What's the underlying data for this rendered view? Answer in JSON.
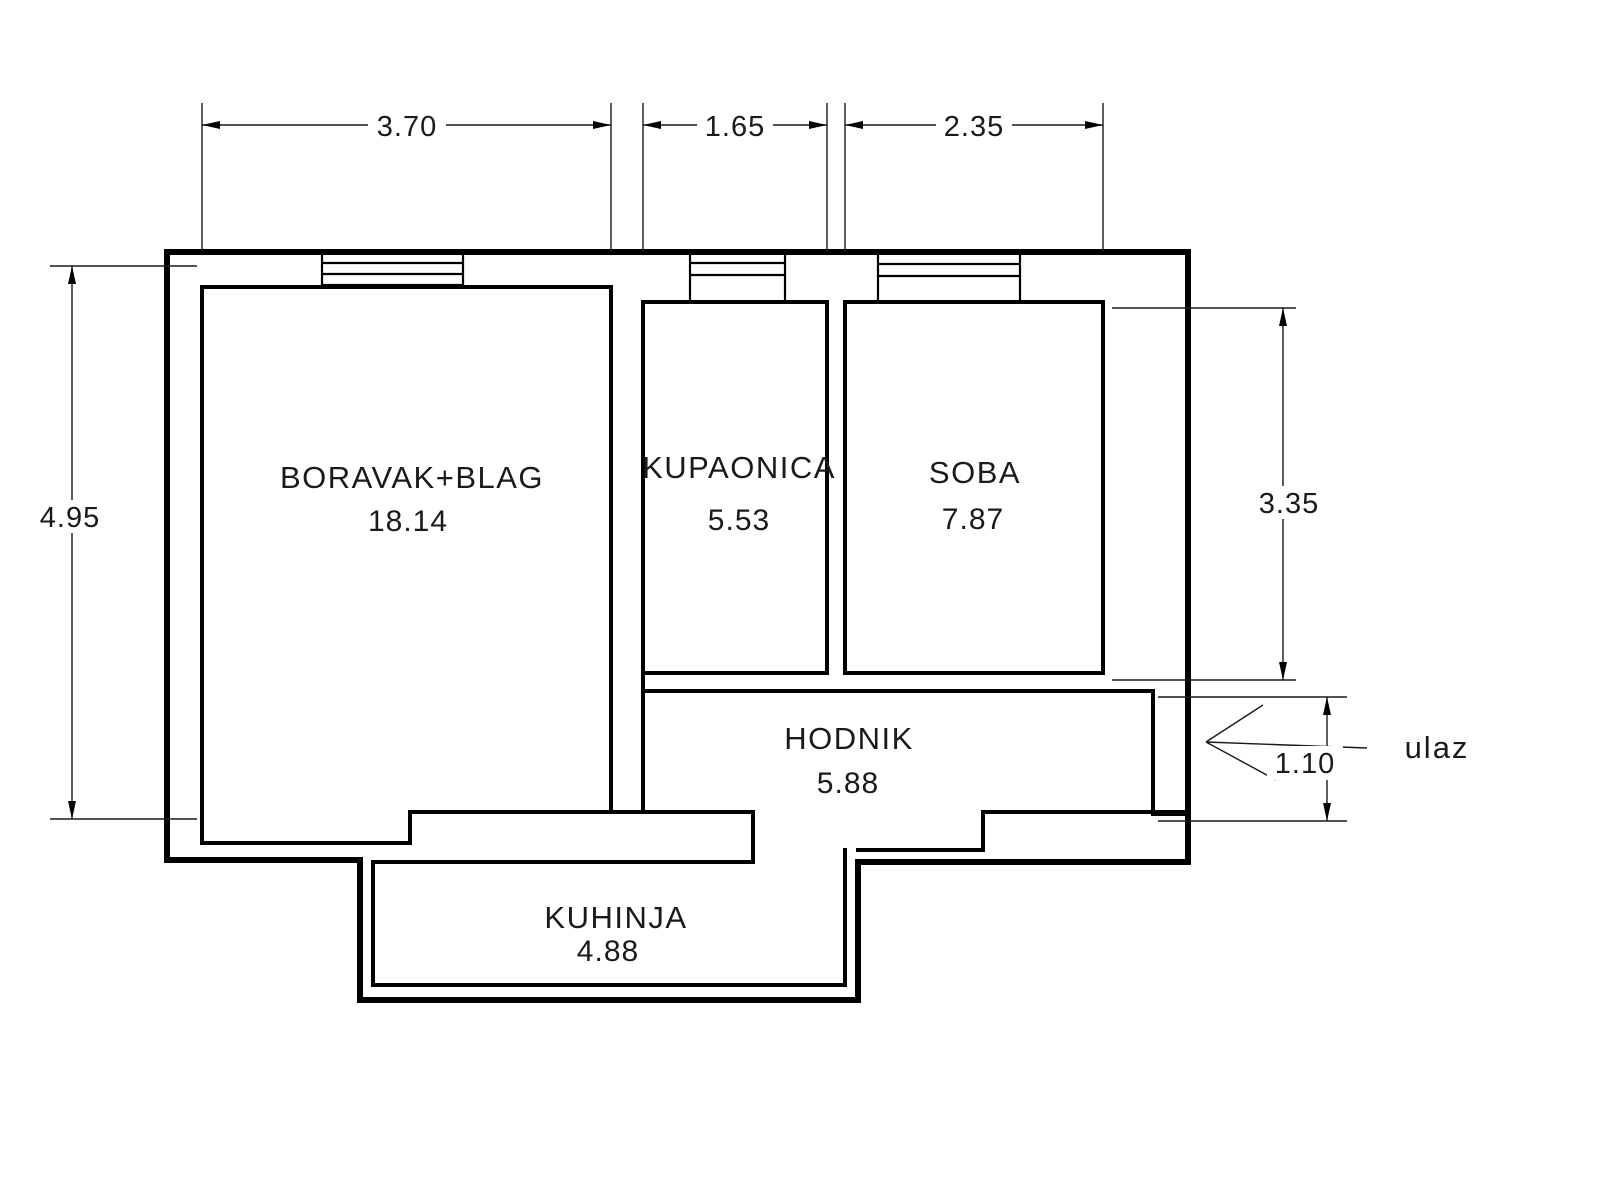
{
  "plan": {
    "type": "apartment-floor-plan",
    "background_color": "#ffffff",
    "line_color": "#000000",
    "text_color": "#1a1a1a",
    "rooms": [
      {
        "id": "living-dining",
        "label": "BORAVAK+BLAG",
        "area": "18.14"
      },
      {
        "id": "bathroom",
        "label": "KUPAONICA",
        "area": "5.53"
      },
      {
        "id": "bedroom",
        "label": "SOBA",
        "area": "7.87"
      },
      {
        "id": "hallway",
        "label": "HODNIK",
        "area": "5.88"
      },
      {
        "id": "kitchen",
        "label": "KUHINJA",
        "area": "4.88"
      }
    ],
    "dimensions": {
      "top_living": {
        "value": "3.70",
        "orientation": "horizontal"
      },
      "top_bathroom": {
        "value": "1.65",
        "orientation": "horizontal"
      },
      "top_bedroom": {
        "value": "2.35",
        "orientation": "horizontal"
      },
      "left_height": {
        "value": "4.95",
        "orientation": "vertical"
      },
      "right_bedroom": {
        "value": "3.35",
        "orientation": "vertical"
      },
      "entrance_door": {
        "value": "1.10",
        "orientation": "vertical"
      }
    },
    "entrance": {
      "label": "ulaz"
    }
  }
}
